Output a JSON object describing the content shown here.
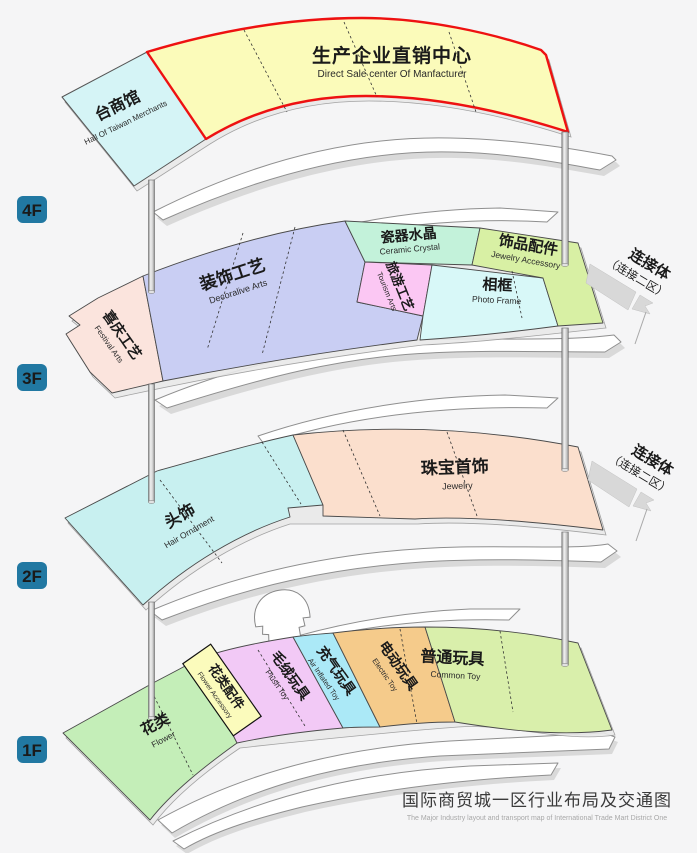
{
  "title": {
    "zh": "国际商贸城一区行业布局及交通图",
    "en": "The Major Industry layout and transport map of International Trade Mart District One"
  },
  "colors": {
    "badge": "#2178a2",
    "badge_text": "#cccccc",
    "direct_sale_border": "#ee1111"
  },
  "floors": [
    {
      "badge": "4F",
      "sections": [
        {
          "zh": "台商馆",
          "en": "Hall Of Taiwan Merchants",
          "color": "#d5f4f6"
        },
        {
          "zh": "生产企业直销中心",
          "en": "Direct Sale center Of Manfacturer",
          "color": "#fbfbba"
        }
      ]
    },
    {
      "badge": "3F",
      "sections": [
        {
          "zh": "喜庆工艺",
          "en": "Festival Arts",
          "color": "#fbe4dd"
        },
        {
          "zh": "装饰工艺",
          "en": "Decoralive Arts",
          "color": "#c9cef3"
        },
        {
          "zh": "瓷器水晶",
          "en": "Ceramic Crystal",
          "color": "#c3f2da"
        },
        {
          "zh": "旅游工艺",
          "en": "Tourism Arts",
          "color": "#fbc7f3"
        },
        {
          "zh": "相框",
          "en": "Photo Frame",
          "color": "#d8f8f8"
        },
        {
          "zh": "饰品配件",
          "en": "Jewelry Accessory",
          "color": "#d8f0a4"
        }
      ]
    },
    {
      "badge": "2F",
      "sections": [
        {
          "zh": "头饰",
          "en": "Hair Ornament",
          "color": "#c8f0f0"
        },
        {
          "zh": "珠宝首饰",
          "en": "Jewelry",
          "color": "#fbdfcd"
        }
      ]
    },
    {
      "badge": "1F",
      "sections": [
        {
          "zh": "花类",
          "en": "Flower",
          "color": "#c4eeb8"
        },
        {
          "zh": "花类配件",
          "en": "Flower Accessory",
          "color": "#fbfbbc"
        },
        {
          "zh": "毛绒玩具",
          "en": "Plush Toy",
          "color": "#f2c9f6"
        },
        {
          "zh": "充气玩具",
          "en": "Air Inflated Toy",
          "color": "#abe9f7"
        },
        {
          "zh": "电动玩具",
          "en": "Electric Toy",
          "color": "#f5cb8b"
        },
        {
          "zh": "普通玩具",
          "en": "Common Toy",
          "color": "#d9efab"
        }
      ]
    }
  ],
  "connectors": [
    {
      "label": "连接体",
      "sub": "（连接二区）"
    },
    {
      "label": "连接体",
      "sub": "（连接二区）"
    }
  ]
}
